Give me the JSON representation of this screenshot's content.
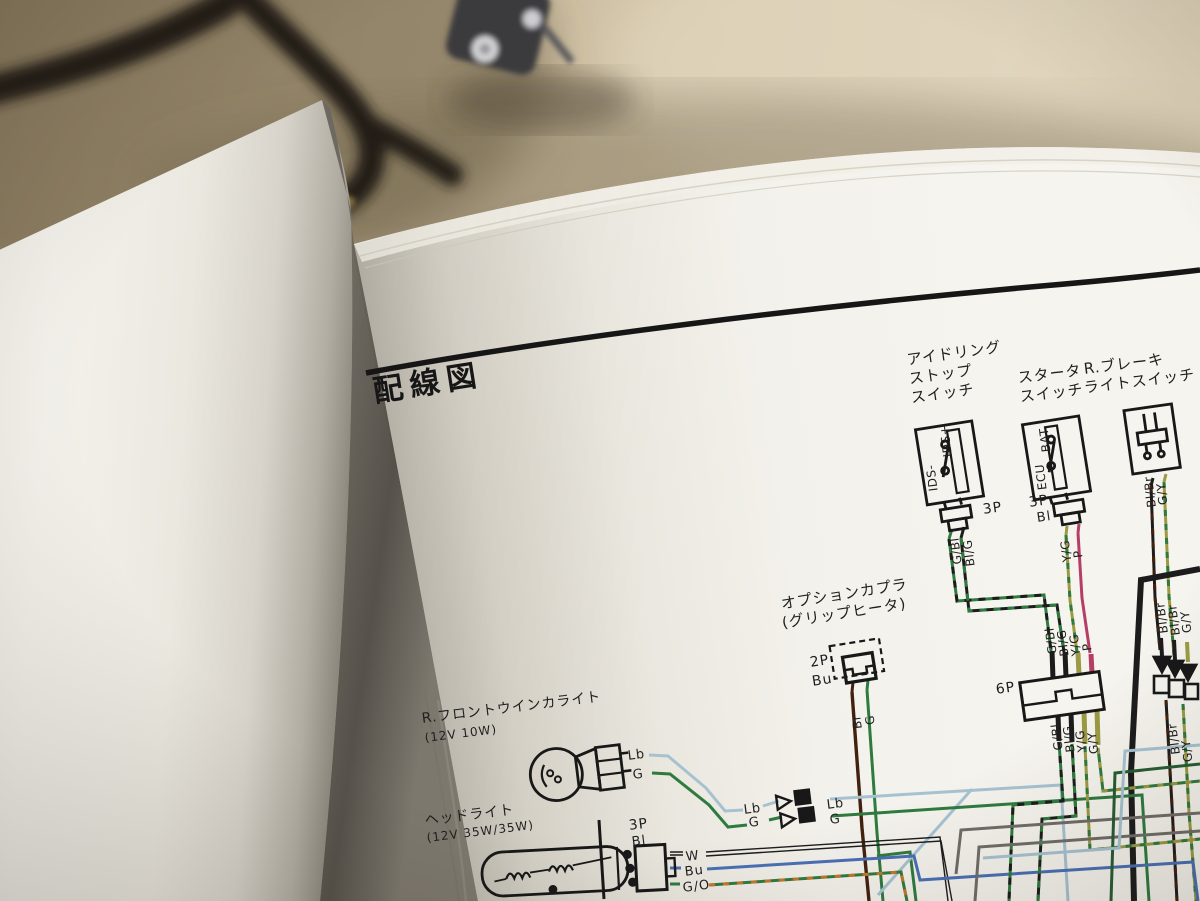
{
  "book": {
    "title": "配線図",
    "diagram": {
      "components": {
        "idling_stop_switch": {
          "name_lines": [
            "アイドリング",
            "ストップ",
            "スイッチ"
          ],
          "terminal_top": "IDS+",
          "terminal_bottom": "IDS-",
          "connector": "3P",
          "wires": [
            "G/Bl",
            "Bl/G"
          ]
        },
        "starter_switch": {
          "name_lines": [
            "スタータ",
            "スイッチ"
          ],
          "terminal_top": "BAT",
          "terminal_bottom": "ECU",
          "connector": "3P",
          "connector_note": "Bl",
          "wires": [
            "Y/G",
            "P"
          ]
        },
        "brake_light_switch": {
          "name_lines": [
            "R.ブレーキ",
            "ライトスイッチ"
          ],
          "wires": [
            "Bl/Br",
            "G/Y"
          ]
        },
        "option_coupler": {
          "name_lines": [
            "オプションカプラ",
            "(グリップヒータ)"
          ],
          "connector": "2P",
          "connector_note": "Bu",
          "wires": [
            "Br",
            "G"
          ]
        },
        "six_p": {
          "label": "6P",
          "wires_top": [
            "G/Bl",
            "Bl/G",
            "Y/G",
            "P"
          ],
          "wires_bottom": [
            "G/Bl",
            "Bl/G",
            "Y/G",
            "G/Y"
          ]
        },
        "bullets": {
          "wires_top": [
            "Bl/Br",
            "Bl/Br",
            "G/Y"
          ],
          "wires_bottom": [
            "Bl/Br",
            "G/Y"
          ]
        },
        "junction": {
          "left": [
            "Lb",
            "G"
          ],
          "right": [
            "Lb",
            "G"
          ]
        },
        "winker": {
          "name_lines": [
            "R.フロントウインカライト",
            "(12V 10W)"
          ],
          "wires": [
            "Lb",
            "G"
          ]
        },
        "headlight": {
          "name_lines": [
            "ヘッドライト",
            "(12V 35W/35W)"
          ],
          "connector": "3P",
          "connector_note": "Bl",
          "wires": [
            "W",
            "Bu",
            "G/O"
          ]
        }
      }
    },
    "wire_colors": {
      "green": "#2e7a3f",
      "dark_green": "#275c33",
      "light_blue": "#a6c2d1",
      "blue": "#4a6fb5",
      "black": "#1c1c1c",
      "brown": "#42210f",
      "olive": "#9b9a43",
      "magenta": "#b53e66",
      "gray": "#6f6d68",
      "orange": "#c5762c"
    }
  }
}
